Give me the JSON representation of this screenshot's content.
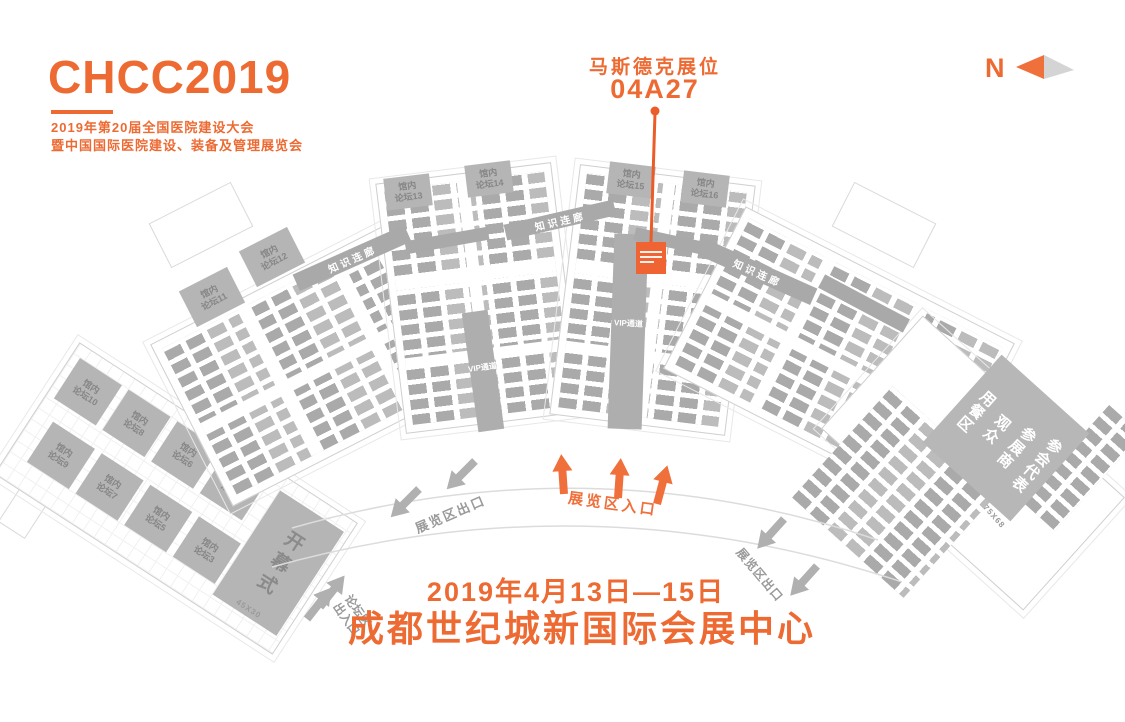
{
  "brand": {
    "logo": "CHCC2019",
    "line1": "2019年第20届全国医院建设大会",
    "line2": "暨中国国际医院建设、装备及管理展览会"
  },
  "callout": {
    "title": "马斯德克展位",
    "booth_no": "04A27"
  },
  "compass": {
    "label": "N"
  },
  "footer": {
    "date": "2019年4月13日—15日",
    "venue": "成都世纪城新国际会展中心"
  },
  "colors": {
    "accent": "#ED6A32",
    "arrow_orange": "#F0703C",
    "highlight_booth": "#F06433",
    "booth_gray": "#BCBCBC",
    "corridor_gray": "#A9A9A9",
    "label_gray": "#9A9A9A"
  },
  "map": {
    "forum_hall": {
      "boxes": [
        {
          "l1": "馆内",
          "l2": "论坛10"
        },
        {
          "l1": "馆内",
          "l2": "论坛8"
        },
        {
          "l1": "馆内",
          "l2": "论坛6"
        },
        {
          "l1": "馆内",
          "l2": "论坛4"
        },
        {
          "l1": "馆内",
          "l2": "论坛9"
        },
        {
          "l1": "馆内",
          "l2": "论坛7"
        },
        {
          "l1": "馆内",
          "l2": "论坛5"
        },
        {
          "l1": "馆内",
          "l2": "论坛3"
        }
      ],
      "opening": "开幕式",
      "opening_dim": "45X30"
    },
    "hall_forums": [
      {
        "l1": "馆内",
        "l2": "论坛11"
      },
      {
        "l1": "馆内",
        "l2": "论坛12"
      },
      {
        "l1": "馆内",
        "l2": "论坛13"
      },
      {
        "l1": "馆内",
        "l2": "论坛14"
      },
      {
        "l1": "馆内",
        "l2": "论坛15"
      },
      {
        "l1": "馆内",
        "l2": "论坛16"
      }
    ],
    "corridor_label": "知识连廊",
    "vip_label": "VIP通道",
    "dining": {
      "line1": "参会代表",
      "line2": "参展商",
      "line3": "观众",
      "line4": "用餐区",
      "dim": "75X68"
    },
    "gates": {
      "exit_left": "展览区出口",
      "entrance": "展览区入口",
      "exit_right": "展览区出口",
      "forum_gate_l1": "论坛区",
      "forum_gate_l2": "出入口"
    }
  }
}
